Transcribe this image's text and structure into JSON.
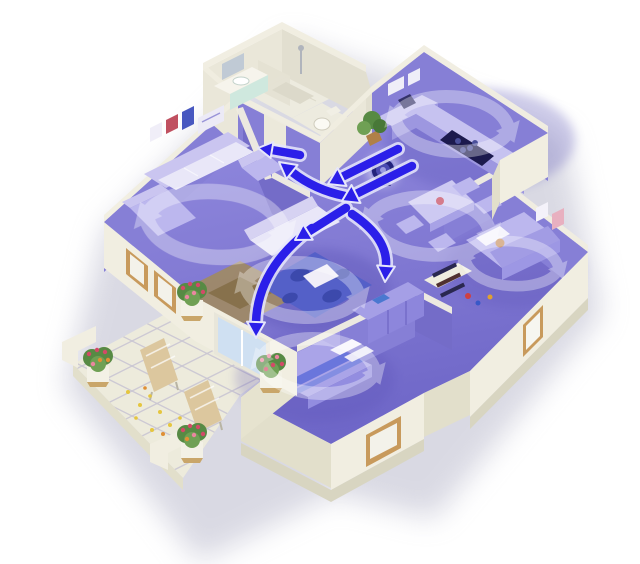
{
  "scene": {
    "title": "Whole-home air circulation 3D floor plan",
    "description": "Isometric cutaway rendering of an apartment; ventilated rooms are tinted purple, translucent white swirls show room air circulation, bright blue arrows show airflow between rooms from a floor fan unit, bathroom block stays white, outdoor terrace with flower planters and sun loungers at lower left.",
    "style": "3d-isometric-cutaway",
    "background": "#ffffff"
  },
  "colors": {
    "wallCream": "#f1eee1",
    "wallCreamShade": "#e2dfcb",
    "wallCreamDark": "#d8d5c1",
    "wallInnerWhite": "#eae7d9",
    "wallPurple": "#867fd6",
    "wallPurpleDark": "#746cc8",
    "floorBath": "#edebdf",
    "terraceTile": "#edebdc",
    "terraceLine": "#c9c6d2",
    "arrowBlue": "#2b1fe9",
    "swirlWhite": "#ffffff",
    "furnitureLight": "#bcb7ee",
    "furnitureMid": "#a29ce4",
    "sofaWhite": "#e9e7f8",
    "counterNavy": "#1c1a4e",
    "rugBrown": "#a08a64",
    "rugBrownDark": "#87714c",
    "rugBlue": "#5460c8",
    "rugBlueDark": "#3c49ac",
    "bedBlanket": "#aaa4e8",
    "bedStripe": "#5a6ad8",
    "plantGreen": "#578a44",
    "flowerRed": "#d34a68",
    "flowerPink": "#ea86a0",
    "flowerOrange": "#df8f35",
    "petalYellow": "#e5c63e",
    "wood": "#c89a5c",
    "glass": "#cfe0f2",
    "fanBody": "#23237c",
    "shadow": "#b4b4c8"
  },
  "building": {
    "rooms": [
      {
        "id": "living-room",
        "label": "Living room",
        "ventilated": true,
        "features": [
          "sofa set",
          "armchair",
          "brown rug with coffee table",
          "wall pictures",
          "windows to terrace"
        ]
      },
      {
        "id": "bathroom",
        "label": "Bathroom",
        "ventilated": false,
        "features": [
          "vanity sink",
          "mirror cabinet",
          "shower with partition"
        ]
      },
      {
        "id": "wc",
        "label": "WC",
        "ventilated": false,
        "features": [
          "toilet"
        ]
      },
      {
        "id": "kitchen",
        "label": "Kitchen",
        "ventilated": true,
        "features": [
          "corner counters",
          "dark cooktop",
          "coffee machine",
          "wall shelves",
          "potted plant"
        ]
      },
      {
        "id": "hallway",
        "label": "Hallway junction",
        "ventilated": true,
        "features": [
          "airflow crossing point"
        ]
      },
      {
        "id": "dining-area",
        "label": "Dining area",
        "ventilated": true,
        "features": [
          "dining table",
          "four chairs",
          "red bowl"
        ]
      },
      {
        "id": "lounge",
        "label": "Lounge",
        "ventilated": true,
        "features": [
          "white sofa",
          "blue patterned rug",
          "coffee table",
          "sliding door to terrace"
        ]
      },
      {
        "id": "kids-bedroom",
        "label": "Kids bedroom",
        "ventilated": true,
        "features": [
          "bed with sleeping child",
          "pillow",
          "toys on floor",
          "wall pictures",
          "window"
        ]
      },
      {
        "id": "master-bedroom",
        "label": "Master bedroom",
        "ventilated": true,
        "features": [
          "double bed with striped blanket",
          "pillows",
          "wardrobe",
          "closet shelves",
          "window"
        ]
      },
      {
        "id": "terrace",
        "label": "Terrace",
        "ventilated": false,
        "features": [
          "4 flower planters",
          "2 sun loungers",
          "scattered yellow petals",
          "tiled floor",
          "low parapet walls"
        ]
      }
    ]
  },
  "airflow": {
    "unit": "floor air circulation fan near kitchen doorway",
    "swirl_rooms": [
      "living-room",
      "kitchen",
      "dining-area",
      "lounge",
      "kids-bedroom",
      "master-bedroom"
    ],
    "arrows": [
      "kitchen doorway to hallway junction (upper parallel arrow)",
      "kitchen doorway to hallway junction (lower parallel arrow)",
      "junction to bathroom corridor, up-left",
      "junction hook over partition into living room",
      "junction down-left into lounge",
      "junction curving down toward dining / kids bedroom",
      "lounge long curve down to master bedroom / terrace door"
    ]
  },
  "terrace": {
    "planters": 4,
    "loungers": 2,
    "petal_clusters": 8
  }
}
